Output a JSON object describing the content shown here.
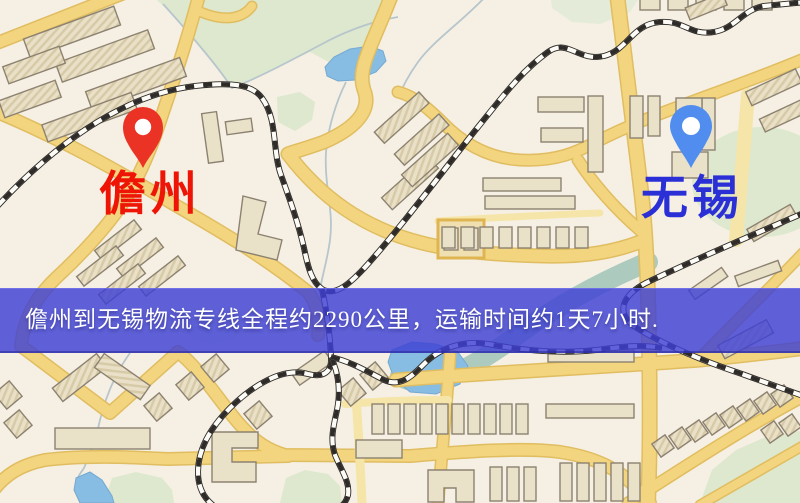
{
  "banner": {
    "text": "儋州到无锡物流专线全程约2290公里，运输时间约1天7小时.",
    "bg_color": "#3e40d4",
    "bg_opacity": 0.82,
    "text_color": "#ffffff"
  },
  "markers": {
    "origin": {
      "label": "儋州",
      "label_color": "#ee1506",
      "pin_color": "#ef3123"
    },
    "destination": {
      "label": "无锡",
      "label_color": "#2b2fd6",
      "pin_color": "#4f8cf2"
    }
  },
  "map": {
    "palette": {
      "bg": "#f5f0e3",
      "road_fill": "#f3d57b",
      "road_casing": "#e2bd5e",
      "road_minor": "#f7e5a6",
      "building_fill": "#eae1c8",
      "building_stroke": "#8d8270",
      "green": "#dde8cd",
      "green_soft": "#e4ecd8",
      "water": "#86bce4",
      "water_edge": "#74a9d4",
      "stream": "#b7c5cd",
      "river": "#accabf",
      "rail_dark": "#2e2b28",
      "rail_light": "#fcfbf6"
    }
  }
}
